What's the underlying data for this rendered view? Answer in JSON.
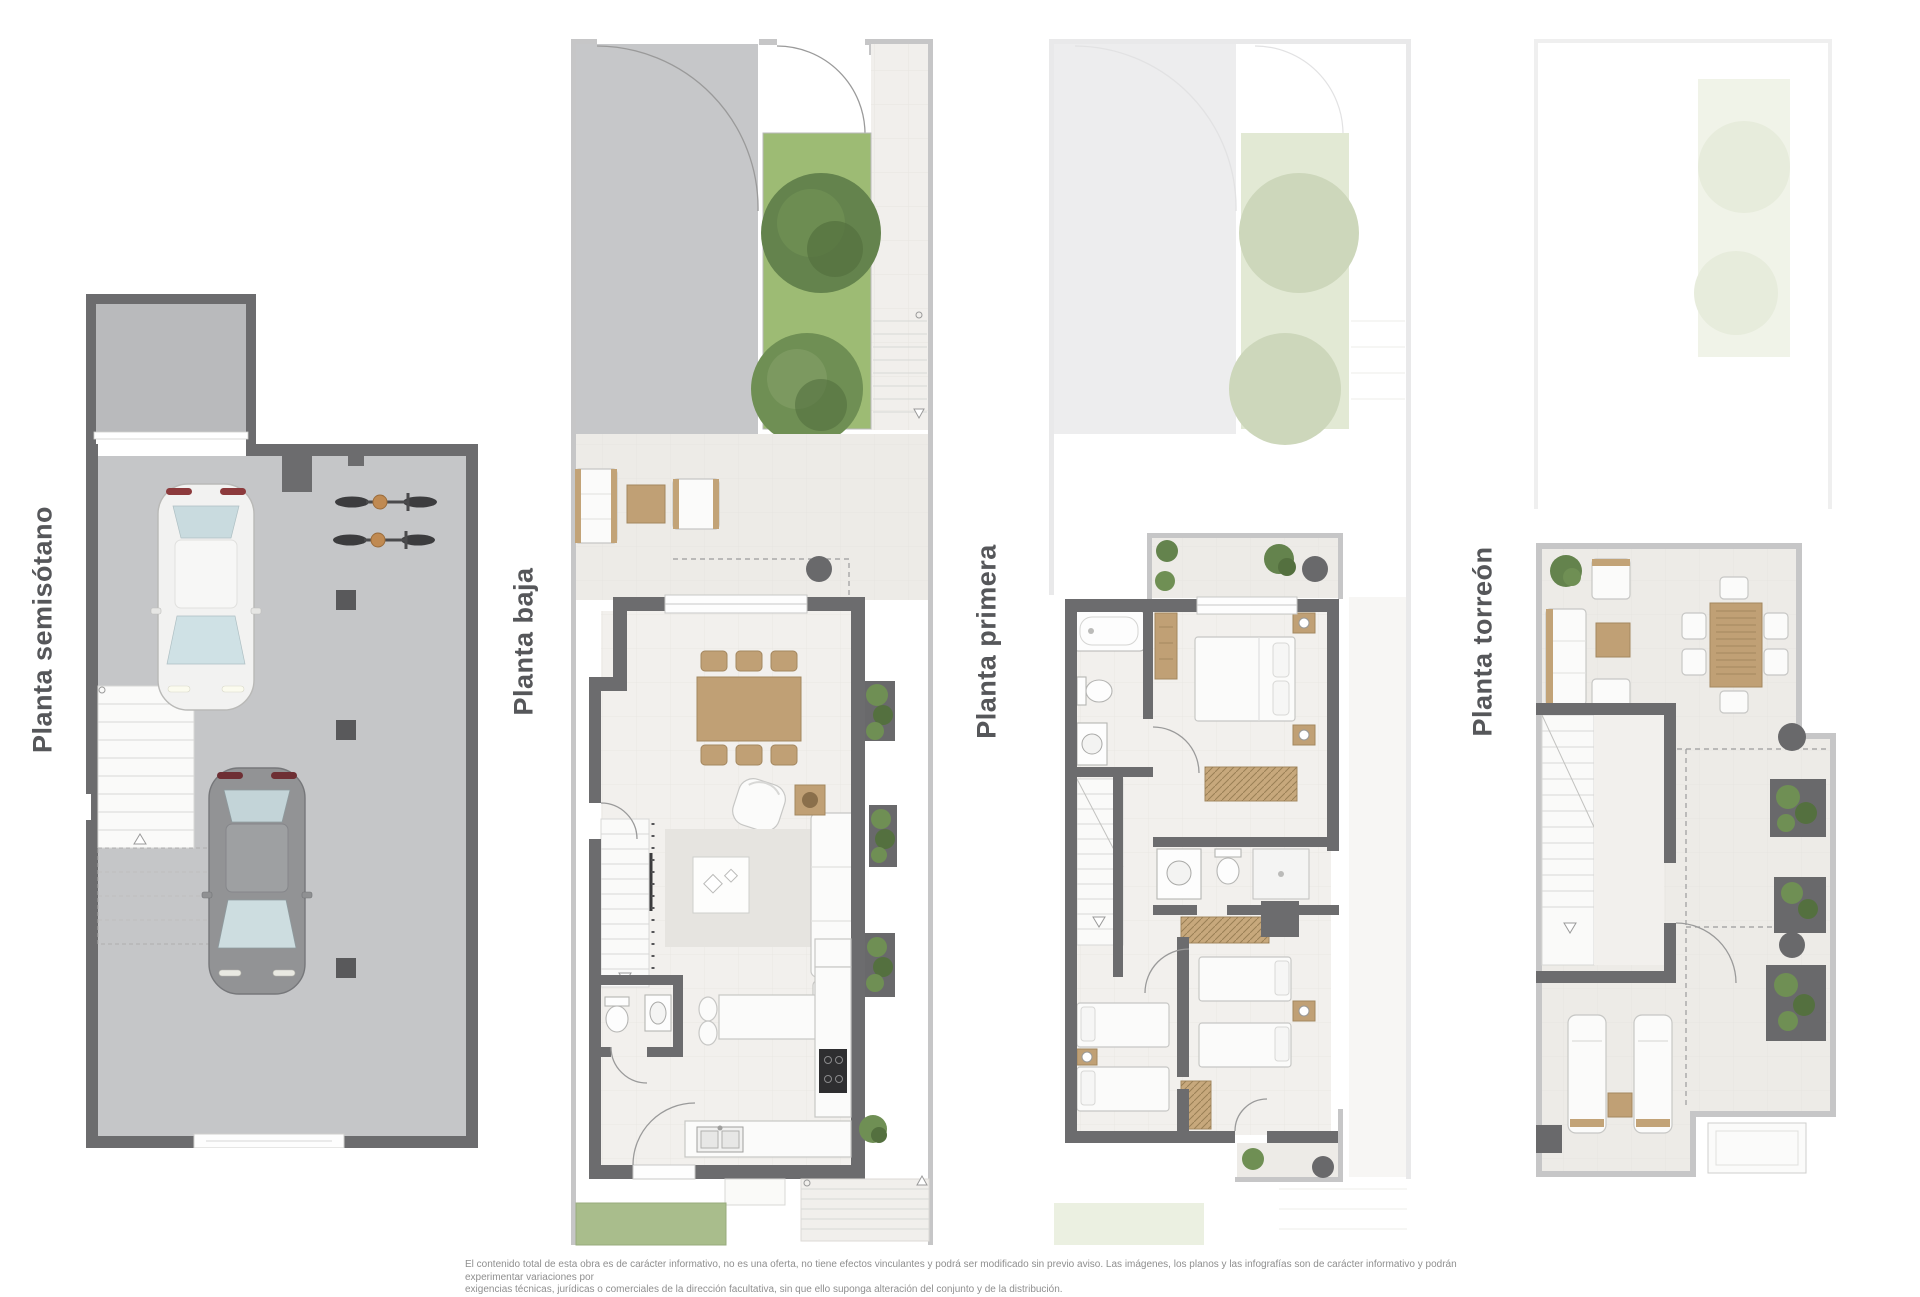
{
  "sheet": {
    "type": "residential-floorplan-sheet",
    "background": "#ffffff"
  },
  "labels": {
    "plan1": "Planta semisótano",
    "plan2": "Planta baja",
    "plan3": "Planta primera",
    "plan4": "Planta torreón"
  },
  "disclaimer": {
    "line1": "El contenido total de esta obra es de carácter informativo, no es una oferta, no tiene efectos vinculantes y podrá ser modificado sin previo aviso. Las imágenes, los planos y las infografías son de carácter informativo y podrán experimentar variaciones por",
    "line2": "exigencias técnicas, jurídicas o comerciales de la dirección facultativa, sin que ello suponga alteración del conjunto y de la distribución."
  },
  "icons": {
    "plan1": [
      "white-car-icon",
      "dark-car-icon",
      "bicycle-icon",
      "stairs-icon",
      "column-icon",
      "garage-door-icon"
    ],
    "plan2": [
      "tree-icon",
      "lawn",
      "driveway",
      "dining-table-icon",
      "sofa-icon",
      "armchair-icon",
      "rug",
      "stairs-icon",
      "kitchen-island-icon",
      "cooktop-icon",
      "sink-icon",
      "toilet-icon",
      "planter-icon",
      "exterior-stairs-icon"
    ],
    "plan3": [
      "bathtub-icon",
      "toilet-icon",
      "sink-icon",
      "double-bed-icon",
      "single-bed-icon",
      "wardrobe-icon",
      "shower-icon",
      "stairs-icon",
      "balcony-plant-icon"
    ],
    "plan4": [
      "lounge-chair-icon",
      "outdoor-sofa-icon",
      "coffee-table-icon",
      "dining-table-icon",
      "sun-lounger-icon",
      "planter-icon",
      "stairs-icon",
      "skylight"
    ]
  },
  "colors": {
    "wall_dark": "#6c6c6e",
    "wall_light": "#c6c6c7",
    "concrete_floor": "#c5c6c8",
    "tile_floor": "#f1efec",
    "lawn": "#9dbb74",
    "tree": "#64834d",
    "wood": "#c0a075",
    "label_text": "#56575a",
    "disclaimer_text": "#8f8f8f"
  }
}
